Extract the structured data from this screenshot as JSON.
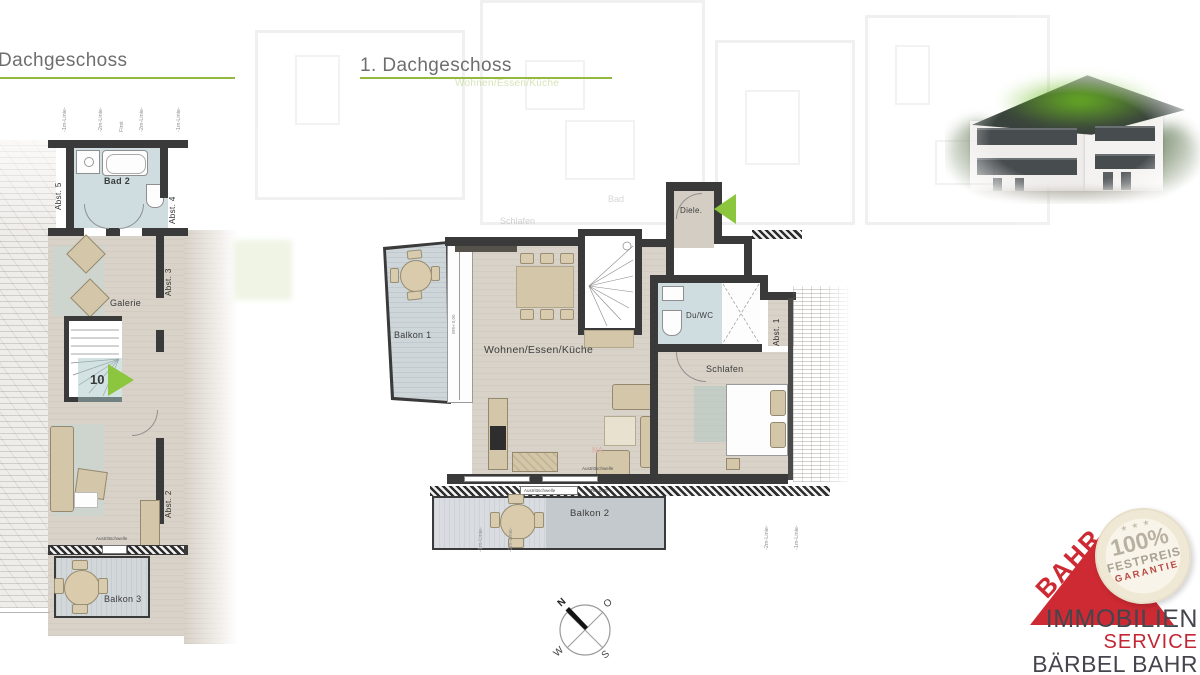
{
  "colors": {
    "accent_green": "#94b941",
    "arrow_green": "#8cc63f",
    "wall": "#3a3a3a",
    "logo_red": "#cd2a33"
  },
  "titles": {
    "left": "Dachgeschoss",
    "right": "1. Dachgeschoss"
  },
  "left_plan": {
    "roof_lines": [
      "-1m-Linie-",
      "-2m-Linie-",
      "First",
      "-2m-Linie-",
      "-1m-Linie-"
    ],
    "labels": {
      "bad2": "Bad 2",
      "abst5": "Abst. 5",
      "abst4": "Abst. 4",
      "abst3": "Abst. 3",
      "galerie": "Galerie",
      "unit_number": "10",
      "abst2": "Abst. 2",
      "balkon3": "Balkon 3",
      "threshold": "Austrittschwelle",
      "brh": "BRH 0,00"
    }
  },
  "right_plan": {
    "labels": {
      "diele": "Diele.",
      "wohnen": "Wohnen/Essen/Küche",
      "duwc": "Du/WC",
      "abst1": "Abst. 1",
      "schlafen": "Schlafen",
      "balkon1": "Balkon 1",
      "balkon2": "Balkon 2",
      "na": "NA",
      "threshold": "Austrittschwelle",
      "brh": "BRH 0,00"
    },
    "height_lines_bottom_left": [
      "-1m-Linie-",
      "-2m-Linie-"
    ],
    "height_lines_bottom_right": [
      "-2m-Linie-",
      "-1m-Linie-"
    ]
  },
  "ghost_plan": {
    "wohnen": "Wohnen/Essen/Küche",
    "schlafen": "Schlafen",
    "bad": "Bad"
  },
  "compass": {
    "north": "N",
    "east": "O",
    "west": "W",
    "south": "S"
  },
  "logo": {
    "brand": "BAHR",
    "badge": {
      "stars": "★ ★ ★",
      "percent": "100%",
      "line1": "FESTPREIS",
      "line2": "GARANTIE"
    },
    "company_line1": "IMMOBILIEN",
    "company_line2": "SERVICE",
    "company_line3": "BÄRBEL BAHR"
  }
}
